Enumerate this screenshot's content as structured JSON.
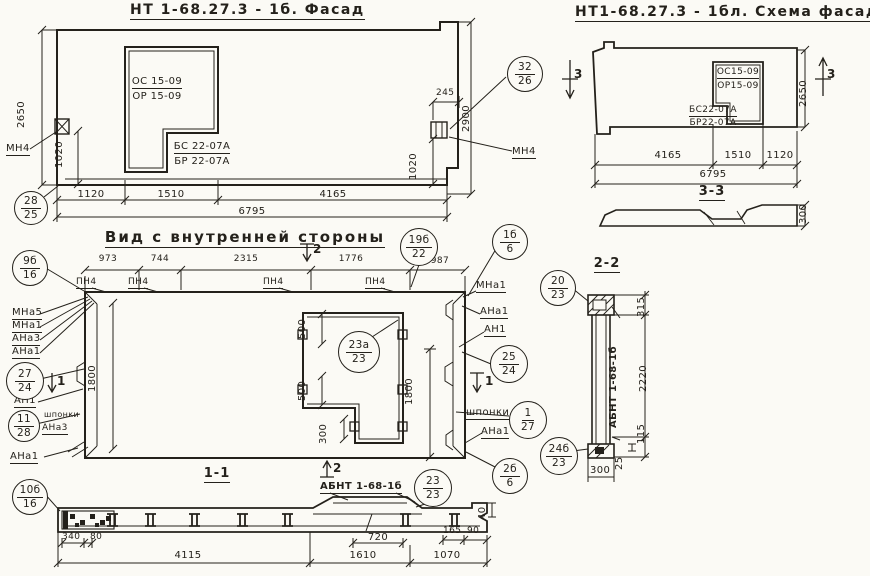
{
  "facade": {
    "title": "НТ 1-68.27.3 - 1б. Фасад",
    "open_top_1": "ОС 15-09",
    "open_top_2": "ОР 15-09",
    "open_bot_1": "БС 22-07А",
    "open_bot_2": "БР 22-07А",
    "dim_height_left": "2650",
    "dim_1020_left": "1020",
    "dim_w1": "1120",
    "dim_w2": "1510",
    "dim_w3": "4165",
    "dim_total": "6795",
    "dim_245": "245",
    "dim_1020_right": "1020",
    "dim_height_right": "2900",
    "mn4": "МН4"
  },
  "schema": {
    "title": "НТ1-68.27.3 - 1бл. Схема фасада",
    "open_top_1": "ОС15-09",
    "open_top_2": "ОР15-09",
    "open_bot_1": "БС22-07А",
    "open_bot_2": "БР22-07А",
    "dim_w1": "4165",
    "dim_w2": "1510",
    "dim_w3": "1120",
    "dim_total": "6795",
    "dim_height": "2650",
    "mark3": "3",
    "section_title": "3-3",
    "section_dim": "300"
  },
  "inner": {
    "title": "Вид с внутренней стороны",
    "dim_t1": "973",
    "dim_t2": "744",
    "dim_t3": "2315",
    "dim_t4": "1776",
    "dim_t5": "987",
    "pn4": "ПН4",
    "mark2": "2",
    "mark1": "1",
    "dim_h_left": "1800",
    "dim_h_right": "1800",
    "dim_o500a": "500",
    "dim_o500b": "500",
    "dim_o300": "300",
    "mna5": "МНа5",
    "mna1": "МНа1",
    "ana3": "АНа3",
    "ana1": "АНа1",
    "an1": "АН1",
    "shponki_left": "шпонки",
    "ana3_left": "АНа3",
    "ana1_bl": "АНа1",
    "mna1_r": "МНа1",
    "ana1_r": "АНа1",
    "an1_r": "АН1",
    "shponki_r": "шпонки",
    "ana1_r2": "АНа1"
  },
  "s11": {
    "title": "1-1",
    "abnt": "АБНТ 1-68-1б",
    "d340": "340",
    "d80": "80",
    "d720": "720",
    "d165": "165",
    "d90": "90",
    "d40": "40",
    "w1": "4115",
    "w2": "1610",
    "w3": "1070"
  },
  "s22": {
    "title": "2-2",
    "abnt": "АБНТ 1-68-1б",
    "d315": "315",
    "d2220": "2220",
    "d115": "115",
    "d25": "25",
    "d300": "300"
  },
  "callouts": {
    "c28_25": {
      "n": "28",
      "d": "25"
    },
    "c32_26": {
      "n": "32",
      "d": "26"
    },
    "c9b_16": {
      "n": "9б",
      "d": "16"
    },
    "c19b_22": {
      "n": "19б",
      "d": "22"
    },
    "c1b_6": {
      "n": "1б",
      "d": "6"
    },
    "c27_24": {
      "n": "27",
      "d": "24"
    },
    "c11_28": {
      "n": "11",
      "d": "28"
    },
    "c10b_16": {
      "n": "10б",
      "d": "16"
    },
    "c23a_23": {
      "n": "23а",
      "d": "23"
    },
    "c25_24": {
      "n": "25",
      "d": "24"
    },
    "c1_27": {
      "n": "1",
      "d": "27"
    },
    "c20_23": {
      "n": "20",
      "d": "23"
    },
    "c24b_23": {
      "n": "24б",
      "d": "23"
    },
    "c2b_6": {
      "n": "2б",
      "d": "6"
    },
    "c23_23": {
      "n": "23",
      "d": "23"
    }
  }
}
